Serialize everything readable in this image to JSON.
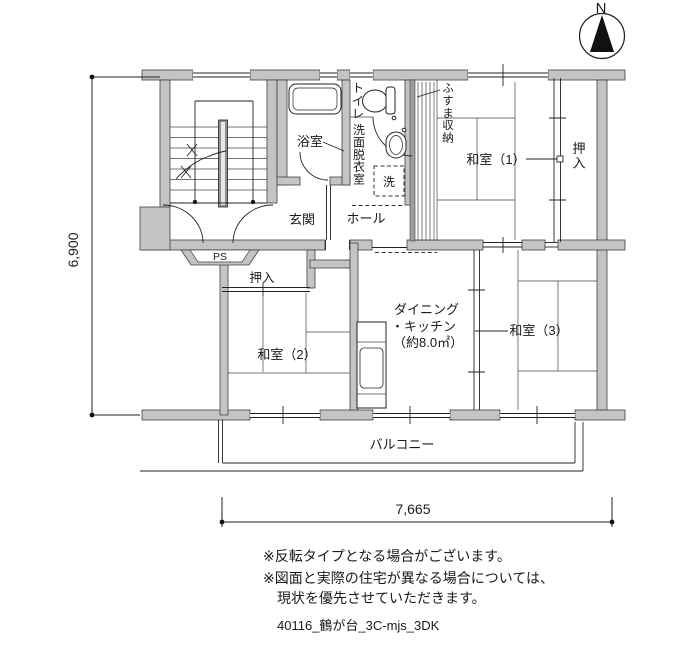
{
  "compass": {
    "north": "N"
  },
  "dimensions": {
    "vertical": "6,900",
    "horizontal": "7,665"
  },
  "rooms": {
    "bathroom": "浴室",
    "toilet": "トイレ",
    "washroom": "洗面脱衣室",
    "washer": "洗",
    "fusuma_storage": "ふすま収納",
    "japanese_room_1": "和室（1）",
    "closet_upper": "押入",
    "entrance": "玄関",
    "hall": "ホール",
    "pipe_shaft": "PS",
    "closet_lower": "押入",
    "japanese_room_2": "和室（2）",
    "dining_kitchen_line1": "ダイニング",
    "dining_kitchen_line2": "・キッチン",
    "dining_kitchen_line3": "（約8.0㎡）",
    "japanese_room_3": "和室（3）",
    "balcony": "バルコニー"
  },
  "notes": {
    "line1": "※反転タイプとなる場合がございます。",
    "line2": "※図面と実際の住宅が異なる場合については、",
    "line3": "現状を優先させていただきます。"
  },
  "footer": {
    "plan_id": "40116_鶴が台_3C-mjs_3DK"
  }
}
